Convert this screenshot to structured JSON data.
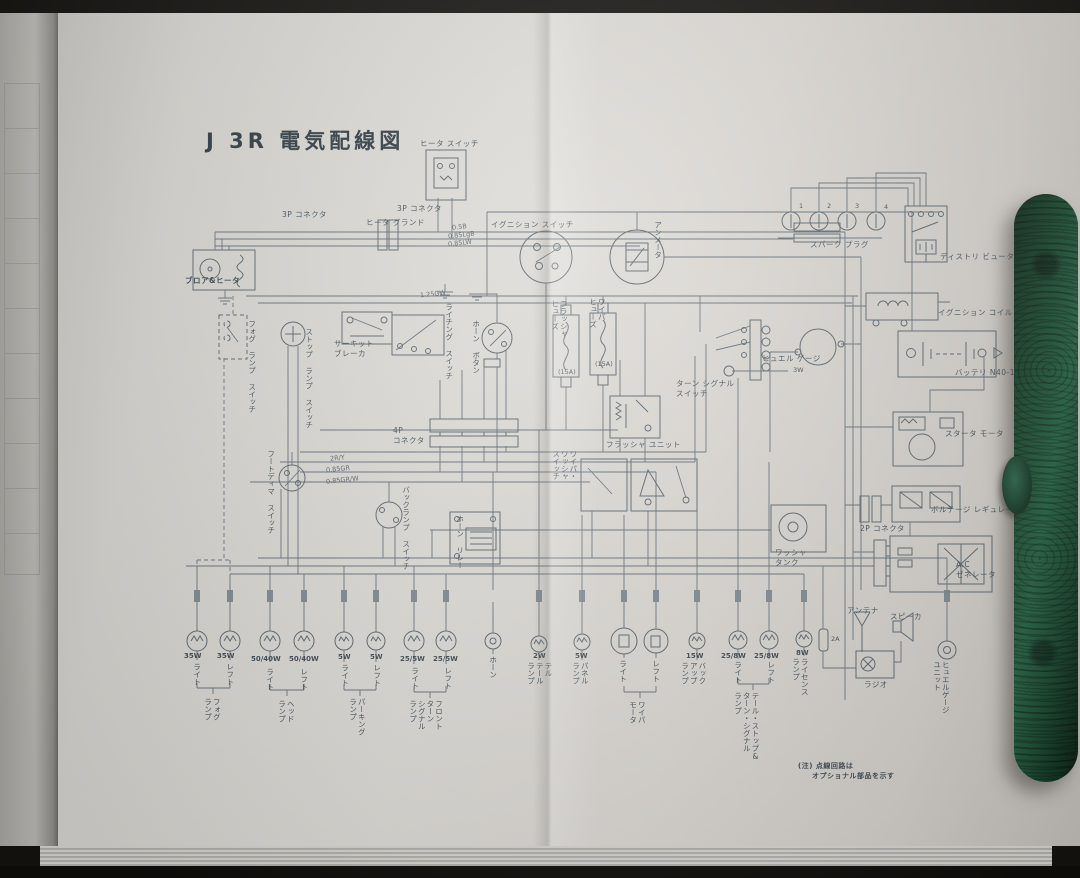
{
  "page": {
    "title": "J 3R 電気配線図",
    "note": {
      "line1": "(注) 点線回路は",
      "line2": "オプショナル部品を示す"
    }
  },
  "labels": {
    "heater_switch": "ヒータ スイッチ",
    "connector_3p_left": "3P コネクタ",
    "heater_ground": "ヒータ グランド",
    "connector_3p_right": "3P コネクタ",
    "blower_heater": "ブロア&ヒータ",
    "ignition_switch": "イグニション スイッチ",
    "ammeter": "アンメータ",
    "spark_plug": "スパーク プラグ",
    "spark_plug_numbers": [
      "1",
      "2",
      "3",
      "4"
    ],
    "distributor": "ディストリ ビュータ",
    "ignition_coil": "イグニション コイル",
    "battery": "バッテリ N40-17",
    "starter_motor": "スタータ モータ",
    "voltage_regulator": "ボルテージ レギュレータ",
    "connector_2p": "2P コネクタ",
    "ac_generator": "A.C\nゼネレータ",
    "fog_lamp_switch": "フォグ ランプ スイッチ",
    "stop_lamp_switch": "ストップ ランプ スイッチ",
    "circuit_breaker": "サーキット\nブレーカ",
    "lighting_switch": "ライチング スイッチ",
    "horn_button": "ホーン ボタン",
    "flasher_fuse": "フラッシャ\nヒューズ",
    "flasher_fuse_rating": "(15A)",
    "wiper_fuse": "ワイパ\nヒューズ",
    "wiper_fuse_rating": "(15A)",
    "turn_signal_switch": "ターン シグナル\nスイッチ",
    "turn_signal_3w": "3W",
    "fuel_gauge": "ヒュエル ゲージ",
    "flasher_unit": "フラッシャ ユニット",
    "connector_4p": "4P\nコネクタ",
    "foot_dimmer_switch": "フートディマ スイッチ",
    "wiper_washer_switch": "ワイパ・\nワッシャ\nスイッチ",
    "back_lamp_switch": "バックランプ スイッチ",
    "horn_relay": "ホーン リレー",
    "washer_tank": "ワッシャ\nタンク",
    "antenna": "アンテナ",
    "speaker": "スピーカ",
    "radio": "ラジオ",
    "fuse_2a": "2A",
    "fuel_gauge_unit": "ヒュエルゲージ\nユニット"
  },
  "wire_labels": [
    "0.5B",
    "0.85LgB",
    "0.85LW",
    "1.25GW",
    "2R/Y",
    "0.85GR",
    "0.85GR/W"
  ],
  "bottom_row": {
    "fog": {
      "watt_r": "35W",
      "watt_l": "35W",
      "side_r": "ライト",
      "side_l": "レフト",
      "name": "フォグ\nランプ"
    },
    "head": {
      "watt_r": "50/40W",
      "watt_l": "50/40W",
      "side_r": "ライト",
      "side_l": "レフト",
      "name": "ヘッド\nランプ"
    },
    "parking": {
      "watt_r": "5W",
      "watt_l": "5W",
      "side_r": "ライト",
      "side_l": "レフト",
      "name": "パーキング\nランプ"
    },
    "front_turn": {
      "watt_r": "25/5W",
      "watt_l": "25/5W",
      "side_r": "ライト",
      "side_l": "レフト",
      "name": "フロント\nターン\nシグナル\nランプ"
    },
    "horn": {
      "name": "ホーン"
    },
    "tell_tale": {
      "watt": "2W",
      "name": "テル\nテール\nランプ"
    },
    "panel": {
      "watt": "5W",
      "name": "パネル\nランプ"
    },
    "wiper_motor": {
      "side_r": "ライト",
      "side_l": "レフト",
      "name": "ワイパ\nモータ"
    },
    "backup": {
      "watt": "15W",
      "name": "バック\nアップ\nランプ"
    },
    "tail": {
      "watt_r": "25/8W",
      "watt_l": "25/8W",
      "side_r": "ライト",
      "side_l": "レフト",
      "name": "テール・ストップ&\nターン・シグナル\nランプ"
    },
    "license": {
      "watt": "8W",
      "name": "ライセンス\nランプ"
    }
  }
}
